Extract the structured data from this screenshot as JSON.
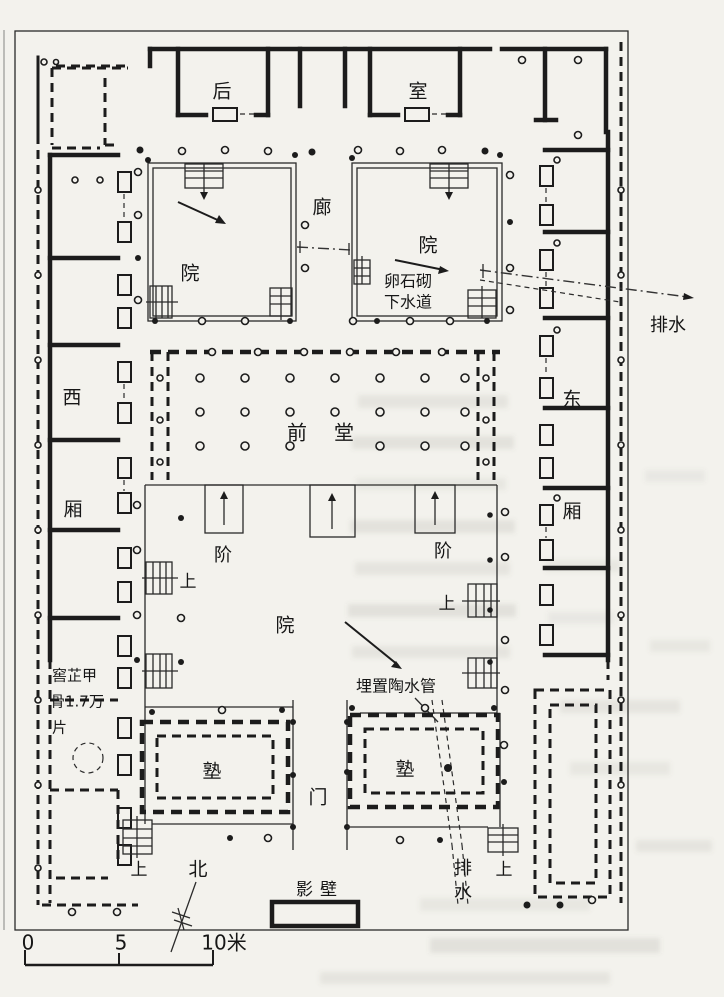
{
  "labels": {
    "rear": "后",
    "room": "室",
    "corridor": "廊",
    "courtyard": "院",
    "cobble_drain_line1": "卵石砌",
    "cobble_drain_line2": "下水道",
    "drainage": "排水",
    "west": "西",
    "wing": "厢",
    "east": "东",
    "front_hall_char1": "前",
    "front_hall_char2": "堂",
    "steps": "阶",
    "up": "上",
    "buried_pipe": "埋置陶水管",
    "oracle_pit_lines": [
      "窖芷甲",
      "骨1.7万",
      "片"
    ],
    "gatehouse": "塾",
    "gate": "门",
    "drainage_vertical": [
      "排",
      "水"
    ],
    "screen_wall": "影壁",
    "north": "北"
  },
  "scale_bar": {
    "tick0": "0",
    "tick5": "5",
    "tick10": "10米"
  }
}
